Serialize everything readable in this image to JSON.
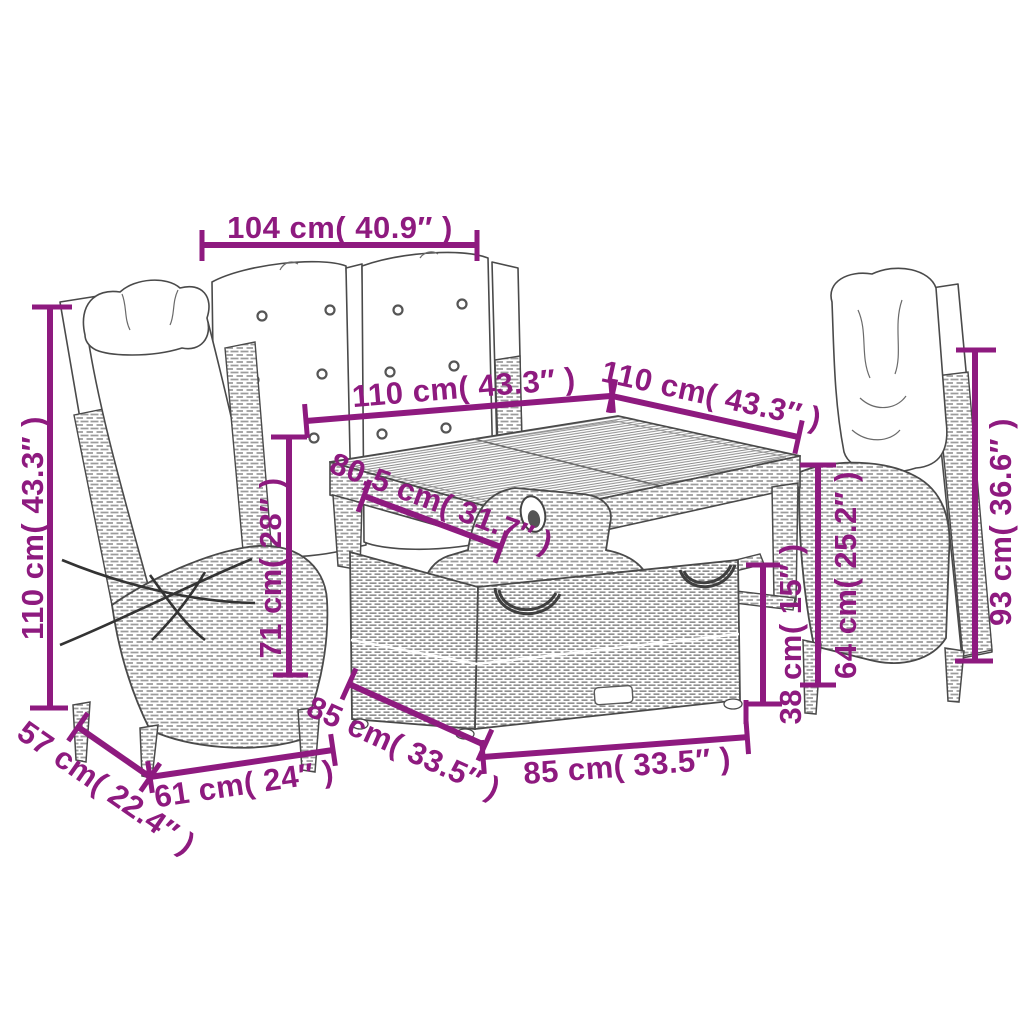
{
  "figure_title": "",
  "colors": {
    "dimension_accent": "#8E1A7F",
    "line_art": "#4A4A4A",
    "background": "#FFFFFF"
  },
  "dims": {
    "top_104": "104 cm( 40.9″ )",
    "table_left_110": "110 cm( 43.3″ )",
    "table_right_110": "110 cm( 43.3″ )",
    "left_chair_height_110": "110 cm( 43.3″ )",
    "table_depth_80_5": "80,5 cm( 31.7″ )",
    "table_height_71": "71 cm( 28″ )",
    "right_chair_height_93": "93 cm( 36.6″ )",
    "armrest_height_64": "64 cm( 25.2″ )",
    "bench_height_38": "38 cm( 15″ )",
    "bench_side_85": "85 cm( 33.5″ )",
    "bench_front_85": "85 cm( 33.5″ )",
    "seat_width_61": "61 cm( 24″ )",
    "seat_depth_57": "57 cm( 22.4″ )"
  }
}
